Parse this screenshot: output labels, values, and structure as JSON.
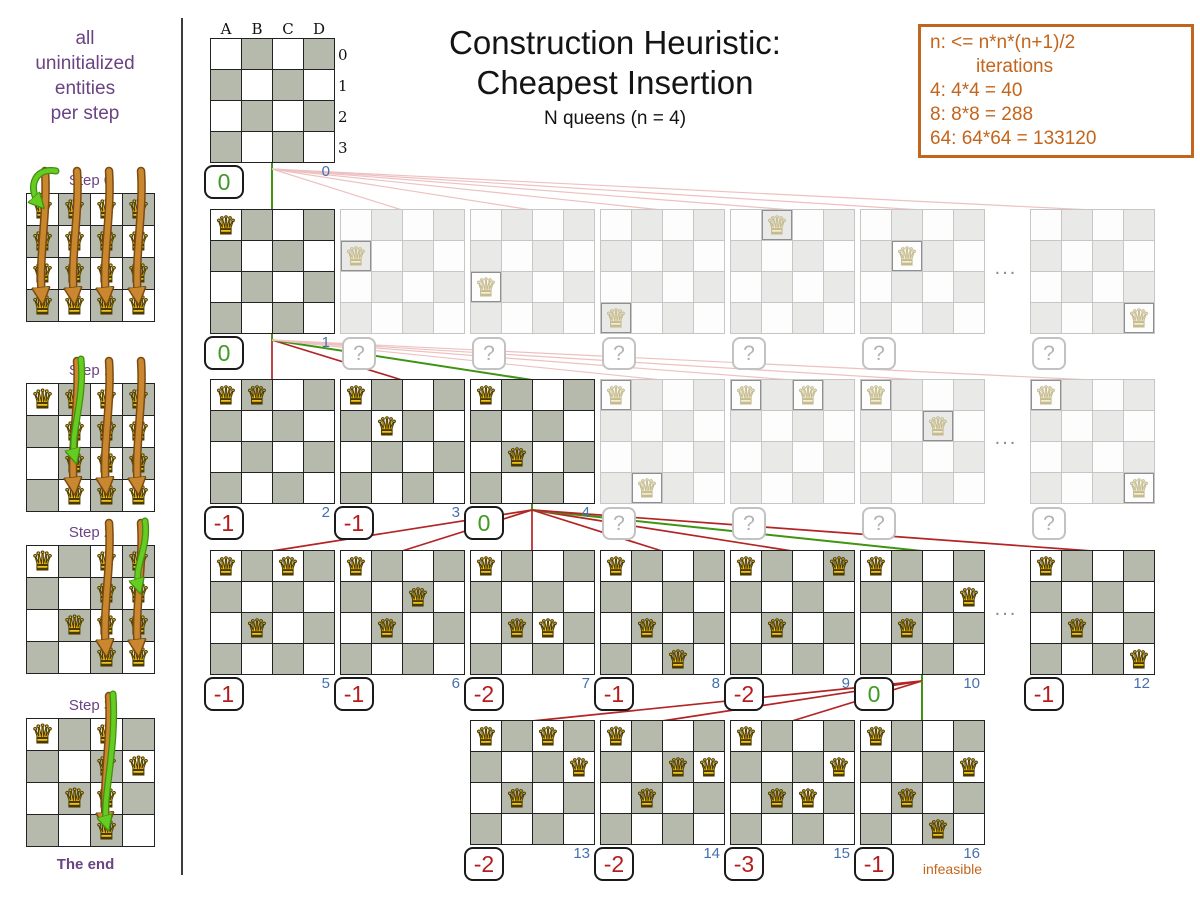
{
  "header": {
    "title_line1": "Construction Heuristic:",
    "title_line2": "Cheapest Insertion",
    "subtitle": "N queens (n = 4)"
  },
  "info_box": {
    "line1": "n: <= n*n*(n+1)/2",
    "line2": "iterations",
    "line3": "4: 4*4 = 40",
    "line4": "8: 8*8 = 288",
    "line5": "64: 64*64 = 133120"
  },
  "sidebar": {
    "caption_line1": "all",
    "caption_line2": "uninitialized",
    "caption_line3": "entities",
    "caption_line4": "per step",
    "end_label": "The end",
    "steps": [
      {
        "label": "Step 0",
        "queens": [
          [
            0,
            0
          ],
          [
            1,
            0
          ],
          [
            2,
            0
          ],
          [
            3,
            0
          ],
          [
            0,
            1
          ],
          [
            1,
            1
          ],
          [
            2,
            1
          ],
          [
            3,
            1
          ],
          [
            0,
            2
          ],
          [
            1,
            2
          ],
          [
            2,
            2
          ],
          [
            3,
            2
          ],
          [
            0,
            3
          ],
          [
            1,
            3
          ],
          [
            2,
            3
          ],
          [
            3,
            3
          ]
        ],
        "orange_arrow_cols": [
          0,
          1,
          2,
          3
        ],
        "green_arrow": {
          "col": 0,
          "row": 0
        }
      },
      {
        "label": "Step 1",
        "queens": [
          [
            0,
            0
          ],
          [
            1,
            0
          ],
          [
            2,
            0
          ],
          [
            3,
            0
          ],
          [
            1,
            1
          ],
          [
            2,
            1
          ],
          [
            3,
            1
          ],
          [
            1,
            2
          ],
          [
            2,
            2
          ],
          [
            3,
            2
          ],
          [
            1,
            3
          ],
          [
            2,
            3
          ],
          [
            3,
            3
          ]
        ],
        "orange_arrow_cols": [
          1,
          2,
          3
        ],
        "green_arrow": {
          "col": 1,
          "row": 2
        }
      },
      {
        "label": "Step 2",
        "queens": [
          [
            0,
            0
          ],
          [
            1,
            2
          ],
          [
            2,
            0
          ],
          [
            3,
            0
          ],
          [
            2,
            1
          ],
          [
            3,
            1
          ],
          [
            2,
            2
          ],
          [
            3,
            2
          ],
          [
            2,
            3
          ],
          [
            3,
            3
          ]
        ],
        "orange_arrow_cols": [
          2,
          3
        ],
        "green_arrow": {
          "col": 3,
          "row": 1
        }
      },
      {
        "label": "Step 3",
        "queens": [
          [
            0,
            0
          ],
          [
            1,
            2
          ],
          [
            3,
            1
          ],
          [
            2,
            0
          ],
          [
            2,
            1
          ],
          [
            2,
            2
          ],
          [
            2,
            3
          ]
        ],
        "orange_arrow_cols": [
          2
        ],
        "green_arrow": {
          "col": 2,
          "row": 3
        }
      }
    ]
  },
  "board_labels": {
    "cols": [
      "A",
      "B",
      "C",
      "D"
    ],
    "rows": [
      "0",
      "1",
      "2",
      "3"
    ]
  },
  "dots_label": "...",
  "tree": {
    "root": {
      "x": 210,
      "y": 38,
      "score": "0",
      "score_type": "positive",
      "iteration": "0"
    },
    "rows": [
      {
        "y": 209,
        "selected": 0,
        "dots": true,
        "boards": [
          {
            "x": 210,
            "queens": [
              [
                0,
                0
              ]
            ],
            "score": "0",
            "score_type": "positive",
            "iteration": "1"
          },
          {
            "x": 340,
            "faded": true,
            "queens": [
              [
                0,
                1
              ]
            ],
            "score": "?"
          },
          {
            "x": 470,
            "faded": true,
            "queens": [
              [
                0,
                2
              ]
            ],
            "score": "?"
          },
          {
            "x": 600,
            "faded": true,
            "queens": [
              [
                0,
                3
              ]
            ],
            "score": "?"
          },
          {
            "x": 730,
            "faded": true,
            "queens": [
              [
                1,
                0
              ]
            ],
            "score": "?"
          },
          {
            "x": 860,
            "faded": true,
            "queens": [
              [
                1,
                1
              ]
            ],
            "score": "?"
          },
          {
            "x": 1030,
            "faded": true,
            "queens": [
              [
                3,
                3
              ]
            ],
            "score": "?"
          }
        ]
      },
      {
        "y": 379,
        "selected": 2,
        "dots": true,
        "boards": [
          {
            "x": 210,
            "queens": [
              [
                0,
                0
              ],
              [
                1,
                0
              ]
            ],
            "score": "-1",
            "score_type": "negative",
            "iteration": "2"
          },
          {
            "x": 340,
            "queens": [
              [
                0,
                0
              ],
              [
                1,
                1
              ]
            ],
            "score": "-1",
            "score_type": "negative",
            "iteration": "3"
          },
          {
            "x": 470,
            "queens": [
              [
                0,
                0
              ],
              [
                1,
                2
              ]
            ],
            "score": "0",
            "score_type": "positive",
            "iteration": "4"
          },
          {
            "x": 600,
            "faded": true,
            "queens": [
              [
                0,
                0
              ],
              [
                1,
                3
              ]
            ],
            "score": "?"
          },
          {
            "x": 730,
            "faded": true,
            "queens": [
              [
                0,
                0
              ],
              [
                2,
                0
              ]
            ],
            "score": "?"
          },
          {
            "x": 860,
            "faded": true,
            "queens": [
              [
                0,
                0
              ],
              [
                2,
                1
              ]
            ],
            "score": "?"
          },
          {
            "x": 1030,
            "faded": true,
            "queens": [
              [
                0,
                0
              ],
              [
                3,
                3
              ]
            ],
            "score": "?"
          }
        ]
      },
      {
        "y": 550,
        "selected": 5,
        "dots": true,
        "boards": [
          {
            "x": 210,
            "queens": [
              [
                0,
                0
              ],
              [
                1,
                2
              ],
              [
                2,
                0
              ]
            ],
            "score": "-1",
            "score_type": "negative",
            "iteration": "5"
          },
          {
            "x": 340,
            "queens": [
              [
                0,
                0
              ],
              [
                1,
                2
              ],
              [
                2,
                1
              ]
            ],
            "score": "-1",
            "score_type": "negative",
            "iteration": "6"
          },
          {
            "x": 470,
            "queens": [
              [
                0,
                0
              ],
              [
                1,
                2
              ],
              [
                2,
                2
              ]
            ],
            "score": "-2",
            "score_type": "negative",
            "iteration": "7"
          },
          {
            "x": 600,
            "queens": [
              [
                0,
                0
              ],
              [
                1,
                2
              ],
              [
                2,
                3
              ]
            ],
            "score": "-1",
            "score_type": "negative",
            "iteration": "8"
          },
          {
            "x": 730,
            "queens": [
              [
                0,
                0
              ],
              [
                1,
                2
              ],
              [
                3,
                0
              ]
            ],
            "score": "-2",
            "score_type": "negative",
            "iteration": "9"
          },
          {
            "x": 860,
            "queens": [
              [
                0,
                0
              ],
              [
                1,
                2
              ],
              [
                3,
                1
              ]
            ],
            "score": "0",
            "score_type": "positive",
            "iteration": "10"
          },
          {
            "x": 1030,
            "queens": [
              [
                0,
                0
              ],
              [
                1,
                2
              ],
              [
                3,
                3
              ]
            ],
            "score": "-1",
            "score_type": "negative",
            "iteration": "12"
          }
        ]
      },
      {
        "y": 720,
        "selected": 3,
        "dots": false,
        "boards": [
          {
            "x": 470,
            "queens": [
              [
                0,
                0
              ],
              [
                2,
                0
              ],
              [
                1,
                2
              ],
              [
                3,
                1
              ]
            ],
            "score": "-2",
            "score_type": "negative",
            "iteration": "13"
          },
          {
            "x": 600,
            "queens": [
              [
                0,
                0
              ],
              [
                2,
                1
              ],
              [
                3,
                1
              ],
              [
                1,
                2
              ]
            ],
            "score": "-2",
            "score_type": "negative",
            "iteration": "14"
          },
          {
            "x": 730,
            "queens": [
              [
                0,
                0
              ],
              [
                3,
                1
              ],
              [
                2,
                2
              ],
              [
                1,
                2
              ]
            ],
            "score": "-3",
            "score_type": "negative",
            "iteration": "15"
          },
          {
            "x": 860,
            "queens": [
              [
                0,
                0
              ],
              [
                3,
                1
              ],
              [
                1,
                2
              ],
              [
                2,
                3
              ]
            ],
            "score": "-1",
            "score_type": "negative",
            "iteration": "16",
            "note": "infeasible"
          }
        ]
      }
    ]
  },
  "colors": {
    "purple": "#6b4383",
    "orange": "#c3651c",
    "score_positive": "#3f9b22",
    "score_negative": "#b31d1d",
    "iteration_blue": "#4470ad",
    "line_green": "#3f9414",
    "line_red": "#b32424",
    "line_pink": "#eec1c1",
    "board_dark_cell": "#b6baac",
    "queen_gold": "#f2c41c"
  }
}
